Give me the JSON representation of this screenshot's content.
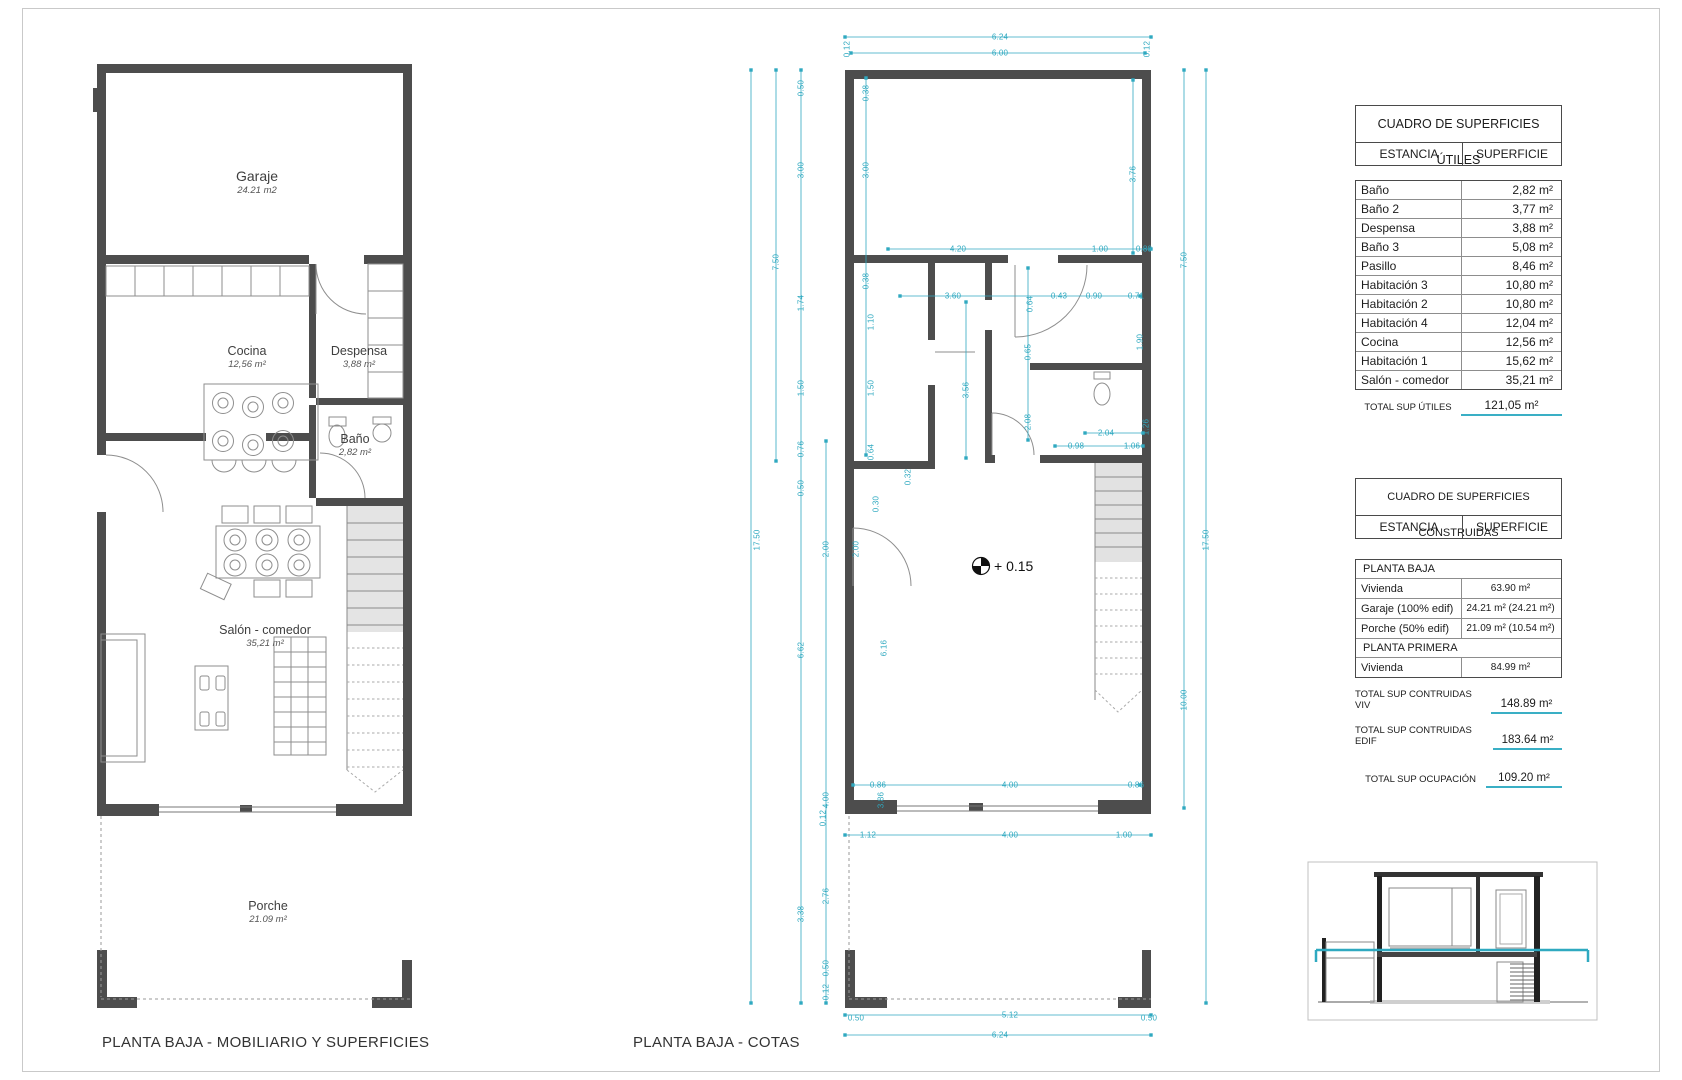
{
  "colors": {
    "dimension_cyan": "#2FA9C0",
    "wall_gray": "#4a4a4a",
    "underline_cyan": "#3AAFC5"
  },
  "captions": {
    "left": "PLANTA BAJA - MOBILIARIO Y SUPERFICIES",
    "middle": "PLANTA BAJA - COTAS"
  },
  "left_plan": {
    "rooms": [
      {
        "name": "Garaje",
        "area": "24.21  m2",
        "x": 257,
        "y": 168,
        "name_size": 14
      },
      {
        "name": "Cocina",
        "area": "12,56 m²",
        "x": 247,
        "y": 344
      },
      {
        "name": "Despensa",
        "area": "3,88 m²",
        "x": 359,
        "y": 344
      },
      {
        "name": "Baño",
        "area": "2,82 m²",
        "x": 355,
        "y": 432
      },
      {
        "name": "Salón - comedor",
        "area": "35,21 m²",
        "x": 265,
        "y": 623
      },
      {
        "name": "Porche",
        "area": "21.09 m²",
        "x": 268,
        "y": 899
      }
    ]
  },
  "middle_plan": {
    "level_text": "+ 0.15",
    "dim_labels": [
      {
        "t": "6.24",
        "x": 1000,
        "y": 37
      },
      {
        "t": "6.00",
        "x": 1000,
        "y": 53
      },
      {
        "t": "0.12",
        "x": 847,
        "y": 49,
        "r": 1
      },
      {
        "t": "0.12",
        "x": 1147,
        "y": 49,
        "r": 1
      },
      {
        "t": "0.50",
        "x": 801,
        "y": 88,
        "r": 1
      },
      {
        "t": "3.00",
        "x": 801,
        "y": 170,
        "r": 1
      },
      {
        "t": "7.50",
        "x": 776,
        "y": 262,
        "r": 1
      },
      {
        "t": "1.74",
        "x": 801,
        "y": 303,
        "r": 1
      },
      {
        "t": "1.50",
        "x": 801,
        "y": 388,
        "r": 1
      },
      {
        "t": "0.76",
        "x": 801,
        "y": 449,
        "r": 1
      },
      {
        "t": "0.50",
        "x": 801,
        "y": 488,
        "r": 1
      },
      {
        "t": "17.50",
        "x": 757,
        "y": 540,
        "r": 1
      },
      {
        "t": "2.00",
        "x": 826,
        "y": 549,
        "r": 1
      },
      {
        "t": "6.62",
        "x": 801,
        "y": 650,
        "r": 1
      },
      {
        "t": "4.00",
        "x": 826,
        "y": 800,
        "r": 1
      },
      {
        "t": "2.76",
        "x": 826,
        "y": 896,
        "r": 1
      },
      {
        "t": "3.38",
        "x": 801,
        "y": 914,
        "r": 1
      },
      {
        "t": "0.50",
        "x": 826,
        "y": 968,
        "r": 1
      },
      {
        "t": "0.12",
        "x": 826,
        "y": 992,
        "r": 1
      },
      {
        "t": "0.38",
        "x": 866,
        "y": 93,
        "r": 1
      },
      {
        "t": "3.00",
        "x": 866,
        "y": 170,
        "r": 1
      },
      {
        "t": "0.38",
        "x": 866,
        "y": 281,
        "r": 1
      },
      {
        "t": "1.10",
        "x": 871,
        "y": 322,
        "r": 1
      },
      {
        "t": "1.50",
        "x": 871,
        "y": 388,
        "r": 1
      },
      {
        "t": "0.64",
        "x": 871,
        "y": 452,
        "r": 1
      },
      {
        "t": "0.30",
        "x": 876,
        "y": 504,
        "r": 1
      },
      {
        "t": "0.32",
        "x": 908,
        "y": 477,
        "r": 1
      },
      {
        "t": "2.00",
        "x": 856,
        "y": 549,
        "r": 1
      },
      {
        "t": "6.16",
        "x": 884,
        "y": 648,
        "r": 1
      },
      {
        "t": "3.86",
        "x": 881,
        "y": 800,
        "r": 1
      },
      {
        "t": "3.56",
        "x": 966,
        "y": 390,
        "r": 1
      },
      {
        "t": "0.64",
        "x": 1030,
        "y": 304,
        "r": 1
      },
      {
        "t": "0.65",
        "x": 1028,
        "y": 352,
        "r": 1
      },
      {
        "t": "2.08",
        "x": 1028,
        "y": 422,
        "r": 1
      },
      {
        "t": "1.90",
        "x": 1140,
        "y": 342,
        "r": 1
      },
      {
        "t": "1.26",
        "x": 1146,
        "y": 427,
        "r": 1
      },
      {
        "t": "3.76",
        "x": 1133,
        "y": 174,
        "r": 1
      },
      {
        "t": "7.50",
        "x": 1184,
        "y": 260,
        "r": 1
      },
      {
        "t": "17.50",
        "x": 1206,
        "y": 540,
        "r": 1
      },
      {
        "t": "10.00",
        "x": 1184,
        "y": 700,
        "r": 1
      },
      {
        "t": "4.20",
        "x": 958,
        "y": 249
      },
      {
        "t": "1.00",
        "x": 1100,
        "y": 249
      },
      {
        "t": "0.80",
        "x": 1144,
        "y": 249
      },
      {
        "t": "3.60",
        "x": 953,
        "y": 296
      },
      {
        "t": "0.43",
        "x": 1059,
        "y": 296
      },
      {
        "t": "0.90",
        "x": 1094,
        "y": 296
      },
      {
        "t": "0.71",
        "x": 1136,
        "y": 296
      },
      {
        "t": "2.04",
        "x": 1106,
        "y": 433
      },
      {
        "t": "0.98",
        "x": 1076,
        "y": 446
      },
      {
        "t": "1.06",
        "x": 1132,
        "y": 446
      },
      {
        "t": "0.86",
        "x": 878,
        "y": 785
      },
      {
        "t": "4.00",
        "x": 1010,
        "y": 785
      },
      {
        "t": "0.86",
        "x": 1136,
        "y": 785
      },
      {
        "t": "0.12",
        "x": 823,
        "y": 818,
        "r": 1
      },
      {
        "t": "1.12",
        "x": 868,
        "y": 835
      },
      {
        "t": "4.00",
        "x": 1010,
        "y": 835
      },
      {
        "t": "1.00",
        "x": 1124,
        "y": 835
      },
      {
        "t": "0.50",
        "x": 856,
        "y": 1018
      },
      {
        "t": "5.12",
        "x": 1010,
        "y": 1015
      },
      {
        "t": "0.50",
        "x": 1149,
        "y": 1018
      },
      {
        "t": "6.24",
        "x": 1000,
        "y": 1035
      }
    ],
    "dim_lines": {
      "v": [
        [
          751,
          70,
          1003
        ],
        [
          776,
          70,
          461
        ],
        [
          801,
          70,
          1003
        ],
        [
          826,
          441,
          1003
        ],
        [
          866,
          78,
          455
        ],
        [
          966,
          302,
          458
        ],
        [
          1028,
          268,
          440
        ],
        [
          1133,
          80,
          253
        ],
        [
          1184,
          70,
          808
        ],
        [
          1206,
          70,
          1003
        ]
      ],
      "h": [
        [
          37,
          845,
          1151
        ],
        [
          53,
          851,
          1145
        ],
        [
          249,
          888,
          1151
        ],
        [
          296,
          900,
          1140
        ],
        [
          433,
          1085,
          1143
        ],
        [
          446,
          1055,
          1143
        ],
        [
          785,
          853,
          1140
        ],
        [
          835,
          845,
          1151
        ],
        [
          1015,
          845,
          1151
        ],
        [
          1035,
          845,
          1151
        ]
      ]
    }
  },
  "tables": {
    "utiles": {
      "title": "CUADRO DE SUPERFICIES ÚTILES",
      "col1": "ESTANCIA",
      "col2": "SUPERFICIE",
      "rows": [
        [
          "Baño",
          "2,82 m²"
        ],
        [
          "Baño 2",
          "3,77 m²"
        ],
        [
          "Despensa",
          "3,88 m²"
        ],
        [
          "Baño 3",
          "5,08 m²"
        ],
        [
          "Pasillo",
          "8,46 m²"
        ],
        [
          "Habitación 3",
          "10,80 m²"
        ],
        [
          "Habitación 2",
          "10,80 m²"
        ],
        [
          "Habitación 4",
          "12,04 m²"
        ],
        [
          "Cocina",
          "12,56 m²"
        ],
        [
          "Habitación 1",
          "15,62 m²"
        ],
        [
          "Salón - comedor",
          "35,21 m²"
        ]
      ],
      "total_label": "TOTAL SUP ÚTILES",
      "total_value": "121,05 m²"
    },
    "construidas": {
      "title": "CUADRO DE SUPERFICIES CONSTRUIDAS",
      "col1": "ESTANCIA",
      "col2": "SUPERFICIE",
      "rows": [
        {
          "label": "PLANTA BAJA",
          "value": "",
          "section": true
        },
        {
          "label": "Vivienda",
          "value": "63.90 m²"
        },
        {
          "label": "Garaje (100% edif)",
          "value": "24.21 m² (24.21 m²)"
        },
        {
          "label": "Porche (50% edif)",
          "value": "21.09 m² (10.54 m²)"
        },
        {
          "label": "PLANTA PRIMERA",
          "value": "",
          "section": true
        },
        {
          "label": "Vivienda",
          "value": "84.99 m²"
        }
      ],
      "totals": [
        [
          "TOTAL SUP CONTRUIDAS VIV",
          "148.89 m²"
        ],
        [
          "TOTAL SUP CONTRUIDAS EDIF",
          "183.64 m²"
        ],
        [
          "TOTAL SUP OCUPACIÓN",
          "109.20 m²"
        ]
      ]
    }
  }
}
